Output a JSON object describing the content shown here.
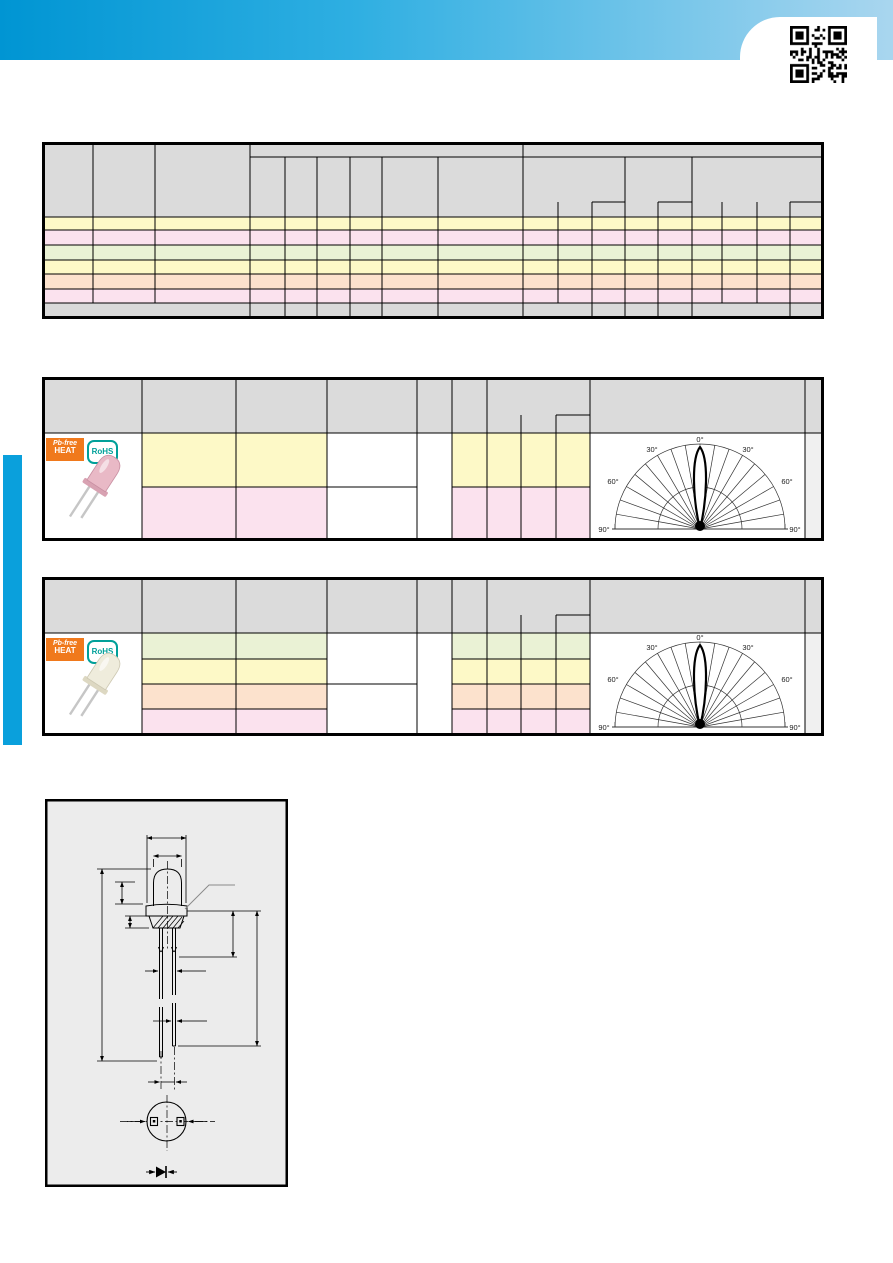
{
  "page": {
    "type": "LED component datasheet page (text redacted)",
    "qr_icon": "qr-code"
  },
  "badges": {
    "pb_free": {
      "line1": "Pb-free",
      "line2": "HEAT"
    },
    "rohs": "RoHS"
  },
  "polar": {
    "l0": "0°",
    "l30": "30°",
    "l60": "60°",
    "l90": "90°"
  },
  "colors": {
    "accent_blue": "#0aa0dc",
    "band_gradient_left": "#0095d3",
    "band_gradient_right": "#a9d6ef",
    "header_gray": "#dbdbdb",
    "footer_gray": "#d9d9d9",
    "light_gray_column": "#f0f0f0",
    "row_yellow": "#fdf9c7",
    "row_pink": "#fbe2ee",
    "row_green": "#eaf2d5",
    "row_orange": "#fce2cd",
    "badge_orange": "#f0791c",
    "badge_teal": "#00a099",
    "led_top_body": "#e9b9c6",
    "led_bottom_body": "#efecdc",
    "dimension_box_bg": "#ececec"
  },
  "tables": {
    "table1": {
      "data_rows": 6,
      "row_colors": [
        "yellow",
        "pink",
        "green",
        "yellow",
        "orange",
        "pink"
      ],
      "footer": "gray merged row"
    },
    "table2": {
      "data_rows": 2,
      "row_colors": [
        "yellow",
        "pink"
      ]
    },
    "table3": {
      "data_rows": 4,
      "row_colors": [
        "green",
        "yellow",
        "orange",
        "pink"
      ]
    }
  },
  "chart_data": [
    {
      "type": "line",
      "title": "radiation pattern (upper product table)",
      "polar": true,
      "angle_ticks_deg": [
        -90,
        -60,
        -30,
        0,
        30,
        60,
        90
      ],
      "tick_labels": [
        "90°",
        "60°",
        "30°",
        "0°",
        "30°",
        "60°",
        "90°"
      ],
      "grid": {
        "radial_lines_every_deg": 10,
        "arcs_at_relative_radius": [
          0.5,
          1.0
        ]
      },
      "series": [
        {
          "name": "relative luminous intensity",
          "x_deg": [
            -90,
            -30,
            -15,
            -10,
            -6,
            -3,
            0,
            3,
            6,
            10,
            15,
            30,
            90
          ],
          "y": [
            0,
            0,
            0.01,
            0.05,
            0.35,
            0.8,
            1.0,
            0.8,
            0.35,
            0.05,
            0.01,
            0,
            0
          ]
        }
      ]
    },
    {
      "type": "line",
      "title": "radiation pattern (lower product table)",
      "polar": true,
      "angle_ticks_deg": [
        -90,
        -60,
        -30,
        0,
        30,
        60,
        90
      ],
      "tick_labels": [
        "90°",
        "60°",
        "30°",
        "0°",
        "30°",
        "60°",
        "90°"
      ],
      "grid": {
        "radial_lines_every_deg": 10,
        "arcs_at_relative_radius": [
          0.5,
          1.0
        ]
      },
      "series": [
        {
          "name": "relative luminous intensity",
          "x_deg": [
            -90,
            -30,
            -15,
            -10,
            -6,
            -3,
            0,
            3,
            6,
            10,
            15,
            30,
            90
          ],
          "y": [
            0,
            0,
            0.01,
            0.05,
            0.35,
            0.8,
            1.0,
            0.8,
            0.35,
            0.05,
            0.01,
            0,
            0
          ]
        }
      ]
    }
  ]
}
